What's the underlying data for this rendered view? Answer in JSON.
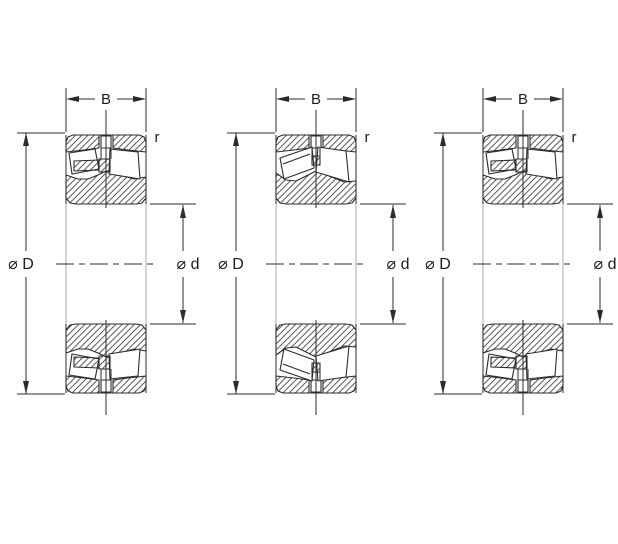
{
  "drawing": {
    "background": "#ffffff",
    "ink_color": "#2b2b2b",
    "bore_edge_color": "#a8a8a8",
    "hatch_color": "#3b3b3b",
    "bearings": [
      {
        "id": "bearing-1",
        "variant": "spherical-roller-with-center-guide-pin",
        "labels": {
          "width": "B",
          "outer_diameter": "⌀ D",
          "bore_diameter": "⌀ d",
          "corner_radius": "r"
        }
      },
      {
        "id": "bearing-2",
        "variant": "spherical-roller-without-center-guide-pin",
        "labels": {
          "width": "B",
          "outer_diameter": "⌀ D",
          "bore_diameter": "⌀ d",
          "corner_radius": "r"
        }
      },
      {
        "id": "bearing-3",
        "variant": "spherical-roller-with-center-guide-pin",
        "labels": {
          "width": "B",
          "outer_diameter": "⌀ D",
          "bore_diameter": "⌀ d",
          "corner_radius": "r"
        }
      }
    ]
  }
}
